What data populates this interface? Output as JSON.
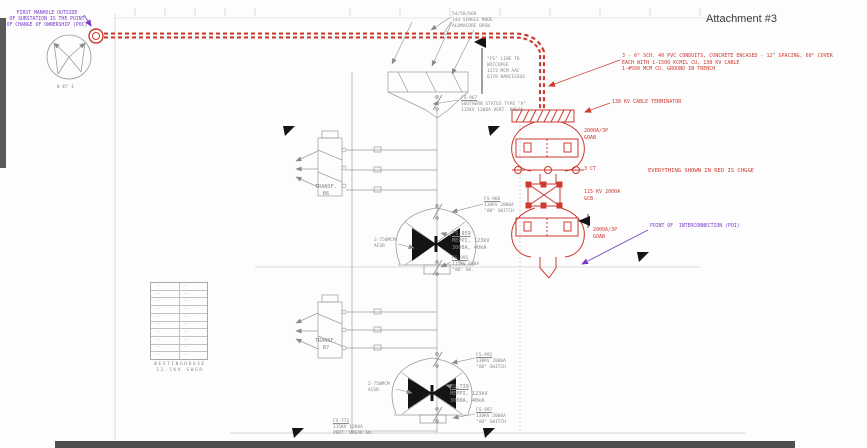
{
  "header": {
    "attachment": "Attachment #3"
  },
  "notes": {
    "poc": "FIRST MANHOLE OUTSIDE\nOF SUBSTATION IS THE POINT\nOF CHANGE OF OWNERSHIP (POC)",
    "opgw": "54/58/669\n144 SINGLE MODE\nALUMACORE OPGW",
    "fs_line": "\"FS\" LINE TO\nWICCOPEE\n1272 MCM AAC\n6178 NARCISSUS",
    "conduit": "3 - 6\" SCH. 40 PVC CONDUITS, CONCRETE ENCASED - 12\" SPACING, 60\" COVER\nEACH WITH 1-1500 KCMIL CU, 138 KV CABLE\n1-#500 MCM CU. GROUND IN TRENCH",
    "terminator": "138 KV CABLE TERMINATOR",
    "red_scope": "EVERYTHING SHOWN IN RED IS CHG&E",
    "poi": "POINT OF  INTERCONNECTION (POI)"
  },
  "red_equipment": {
    "goab_top": "2000A/3P\nGOAB",
    "ct": "3 CT",
    "gcb": "115 KV 2000A\nGCB",
    "goab_bottom": "2000A/3P\nGOAB"
  },
  "labels": {
    "fs967": "FS-967\nSOUTHERN STATES TYPE \"V\"\n115KV 1200A VERT. BREAK",
    "transf_b6": "TRANSF.\nB6",
    "fs968": "FS-968\n138KV 2000A\n\"AB\" SWITCH",
    "fs959": "FS-959\nMEPPI, 123kV\n3000A, 40kA",
    "acsr_top": "2-750MCM\nACSR",
    "fs991": "FS-991\n115KV 600A\n\"AB\" SW.",
    "transf_b7": "TRANSF.\nB7",
    "fs992": "FS-992\n138KV 2000A\n\"AB\" SWITCH",
    "fs739": "FS-739\nMEPPI, 123kV\n3000A, 40kA",
    "acsr_bottom": "2-750MCM\nACSR",
    "fs997": "FS-997\n138KV 2000A\n\"AB\" SWITCH",
    "fs771": "FS-771\n115KV 1200A\nVERT. BREAK SW.",
    "swgr": "WESTINGHOUSE\n12.5KV SWGR",
    "compass": "N 45° E"
  },
  "breaker_table": {
    "rows": [
      {
        "a": "··",
        "b": "··"
      },
      {
        "a": "··",
        "b": "··"
      },
      {
        "a": "··",
        "b": "··"
      },
      {
        "a": "··",
        "b": "··"
      },
      {
        "a": "··",
        "b": "··"
      },
      {
        "a": "··",
        "b": "··"
      },
      {
        "a": "··",
        "b": "··"
      },
      {
        "a": "··",
        "b": "··"
      },
      {
        "a": "··",
        "b": "··"
      },
      {
        "a": "··",
        "b": "··"
      }
    ]
  },
  "colors": {
    "red": "#cc3a30",
    "purple": "#7a3bcb",
    "line_gray": "#a0a0a0",
    "dark_bar": "#4f4f4f"
  }
}
